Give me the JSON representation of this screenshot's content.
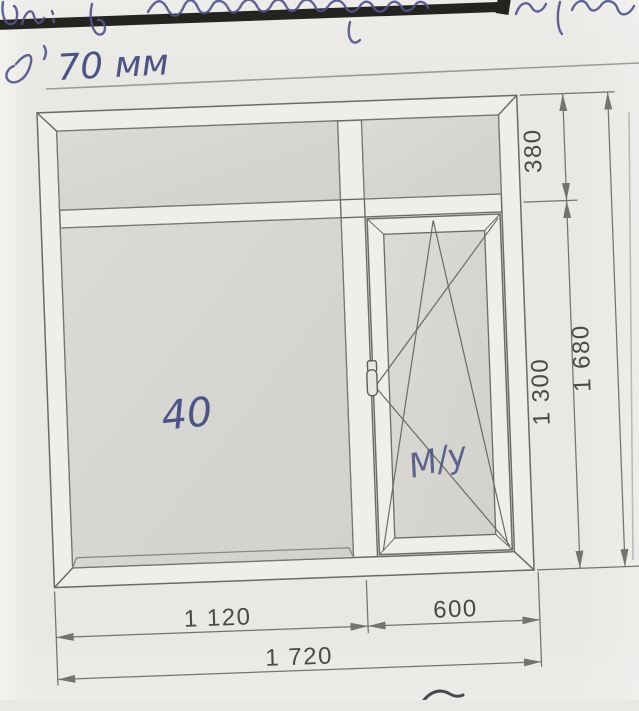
{
  "handwriting": {
    "top_note": "70 мм",
    "pane_note": "40",
    "sash_note": "М/у"
  },
  "dimensions": {
    "transom_height": "380",
    "sash_section_height": "1 300",
    "total_height": "1 680",
    "fixed_width": "1 120",
    "sash_width": "600",
    "total_width": "1 720"
  },
  "colors": {
    "paper": "#e9e8e5",
    "glass": "#d7d6d2",
    "drawing_line": "#6b6b66",
    "dimension_text": "#4a4a46",
    "ink_blue": "#4d5384",
    "heavy_bar": "#242320"
  }
}
